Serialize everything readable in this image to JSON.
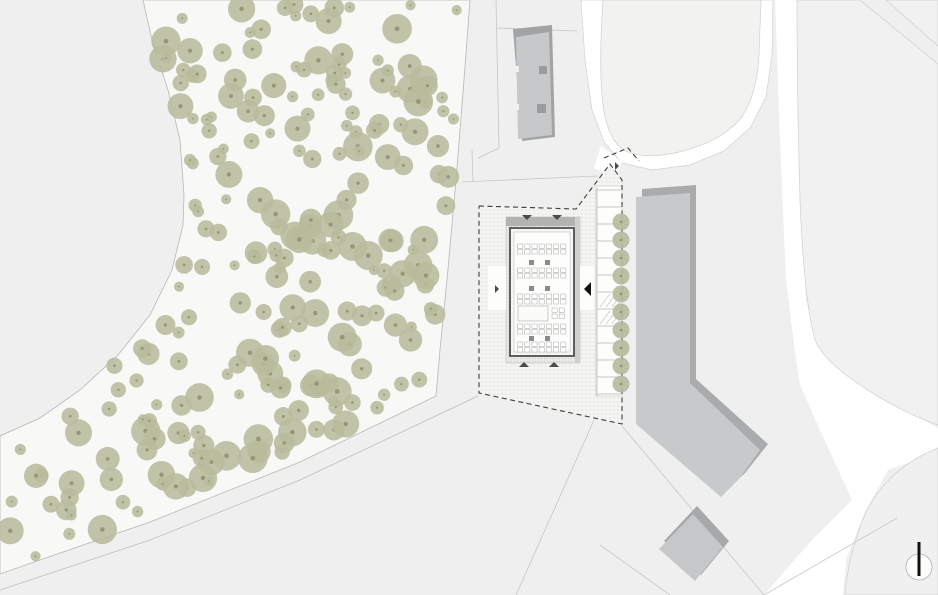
{
  "canvas": {
    "w": 938,
    "h": 595,
    "background": "#efefef"
  },
  "palette": {
    "base": "#efefef",
    "woodland": "#f8f8f6",
    "road": "#ffffff",
    "parcel": "#f1f1f2",
    "parcel_line": "#c6c6c4",
    "tree_fill": "#b7bb9c",
    "tree_dot": "#8f946f",
    "building_fill": "#c8c9ca",
    "building_shadow": "#a8a9ab",
    "deck_fill": "#e9e9e7",
    "roof_shade": "#b3b3b1",
    "wall_stroke": "#4f4f53",
    "floor_fill": "#fdfdfc",
    "furniture_stroke": "#a8a8a6",
    "column_fill": "#8b8b8d",
    "boundary_dash": "#3d3d3d",
    "stipple_dot": "#c8c8c4",
    "north_needle": "#111111"
  },
  "shapes": [
    {
      "name": "base-ground",
      "type": "rect",
      "x": 0,
      "y": 0,
      "w": 938,
      "h": 595,
      "fill": "#efefef"
    },
    {
      "name": "woodland-area",
      "type": "polygon",
      "points": "143,0 470,0 464,80 456,180 447,280 440,350 436,396 300,462 150,522 40,560 0,574 0,436 40,418 80,390 118,355 150,315 172,270 183,225 184,195 180,140 168,90 152,40",
      "fill": "#f8f8f6",
      "stroke": "#b7b7b5",
      "sw": 0.8
    },
    {
      "name": "footpath-lower-line",
      "type": "polyline",
      "points": "0,590 150,540 300,480 440,414 478,396",
      "stroke": "#bdbdbb",
      "sw": 0.8
    },
    {
      "name": "road-top-loop",
      "type": "polygon",
      "points": "581,0 585,60 592,110 604,142 622,163 652,170 690,165 724,151 750,128 766,97 772,55 773,0",
      "fill": "#ffffff",
      "stroke": "#d2d2d0",
      "sw": 0.7
    },
    {
      "name": "parcel-island-north",
      "type": "path",
      "d": "M603,0 Q599,60 602,95 Q605,135 622,149 Q640,160 675,153 Q720,143 741,118 Q757,95 759,55 L761,0 Z",
      "fill": "#f2f3f1",
      "stroke": "#cfcfcd",
      "sw": 0.7
    },
    {
      "name": "road-entrance-spur",
      "type": "polygon",
      "points": "601,146 622,162 616,178 594,168",
      "fill": "#ffffff"
    },
    {
      "name": "road-east-vertical",
      "type": "polygon",
      "points": "775,0 799,0 800,150 806,300 817,342 795,352 786,280 780,140",
      "fill": "#ffffff"
    },
    {
      "name": "road-southeast-wedge",
      "type": "polygon",
      "points": "795,352 817,342 852,376 892,402 938,428 938,452 888,470 864,514 846,560 843,595 764,595 812,540 852,500 820,430 800,385",
      "fill": "#ffffff"
    },
    {
      "name": "parcel-east",
      "type": "path",
      "d": "M797,0 L860,0 L938,64 L938,425 L920,418 Q885,403 850,378 Q822,357 815,340 Q804,300 800,200 Q797,90 797,0 Z",
      "fill": "#f1f1f2",
      "stroke": "#cfcfcd",
      "sw": 0.7
    },
    {
      "name": "parcel-corner-northeast",
      "type": "polygon",
      "points": "886,0 938,0 938,46",
      "fill": "#f1f1f2",
      "stroke": "#cfcfcd",
      "sw": 0.7
    },
    {
      "name": "parcel-southeast",
      "type": "path",
      "d": "M938,448 Q888,468 866,512 Q848,555 845,595 L938,595 Z",
      "fill": "#f0f0f1",
      "stroke": "#cfcfcd",
      "sw": 0.7
    },
    {
      "name": "parcel-lines",
      "type": "lines",
      "stroke": "#c6c6c4",
      "sw": 0.8,
      "items": [
        "496,0 499,148",
        "499,148 478,158",
        "462,182 597,176",
        "472,150 473,182",
        "497,28 577,31",
        "594,420 516,595",
        "622,426 764,595",
        "764,595 897,518",
        "670,595 600,545"
      ]
    },
    {
      "name": "site-ground",
      "type": "stipple-polygon",
      "points": "479,206 576,209 610,164 622,180 622,424 479,393",
      "fill": "#f4f4f2",
      "pattern": "dots"
    },
    {
      "name": "parking-area",
      "type": "rect",
      "x": 596,
      "y": 186,
      "w": 26,
      "h": 210,
      "fill": "#fdfdfc",
      "stroke": "#c9c9c7",
      "sw": 0.7
    },
    {
      "name": "parking-stalls",
      "type": "parking",
      "x1": 597,
      "x2": 621,
      "yStart": 190,
      "yEnd": 394,
      "count": 13,
      "hatch": [
        6,
        7
      ],
      "stroke": "#b4b4b2",
      "sw": 0.7
    },
    {
      "name": "site-boundary",
      "type": "dashed",
      "points": "479,206 576,209 610,164 622,180 622,424 479,393 479,206",
      "stroke": "#3d3d3d",
      "sw": 1.1,
      "dash": "5,3.5"
    },
    {
      "name": "site-boundary-entrance",
      "type": "dashed",
      "points": "604,158 628,148 639,161",
      "stroke": "#3d3d3d",
      "sw": 1.1,
      "dash": "5,3.5"
    },
    {
      "name": "main-building-deck",
      "type": "rect",
      "x": 506,
      "y": 217,
      "w": 74,
      "h": 146,
      "fill": "#e9e9e7",
      "stroke": "#b9b9b7",
      "sw": 0.6
    },
    {
      "name": "main-building-deck-stipple",
      "type": "stipple-rect",
      "x": 506,
      "y": 217,
      "w": 74,
      "h": 146,
      "pattern": "dots2"
    },
    {
      "name": "main-building-roof-shade-top",
      "type": "rect",
      "x": 506,
      "y": 217,
      "w": 74,
      "h": 9,
      "fill": "#b3b3b1"
    },
    {
      "name": "main-building-roof-shade-right",
      "type": "rect",
      "x": 575,
      "y": 217,
      "w": 5,
      "h": 146,
      "fill": "#cfcfcd"
    },
    {
      "name": "entry-court-west",
      "type": "rect",
      "x": 488,
      "y": 266,
      "w": 18,
      "h": 44,
      "fill": "#fdfdfc"
    },
    {
      "name": "entry-court-east",
      "type": "rect",
      "x": 580,
      "y": 266,
      "w": 14,
      "h": 44,
      "fill": "#fdfdfc"
    },
    {
      "name": "main-building-wall",
      "type": "rect",
      "x": 510,
      "y": 228,
      "w": 64,
      "h": 128,
      "fill": "#f5f5f3",
      "stroke": "#4f4f53",
      "sw": 1.8
    },
    {
      "name": "main-building-floor",
      "type": "rect",
      "x": 514,
      "y": 232,
      "w": 56,
      "h": 120,
      "fill": "#fdfdfc",
      "stroke": "#b5b5b3",
      "sw": 0.5
    },
    {
      "name": "main-building-furniture",
      "type": "furniture",
      "fx": 514,
      "fy": 232,
      "fw": 56,
      "rows": [
        {
          "t": "grid",
          "y": 12
        },
        {
          "t": "cols",
          "y": 28
        },
        {
          "t": "grid",
          "y": 36
        },
        {
          "t": "cols",
          "y": 54
        },
        {
          "t": "grid",
          "y": 62
        },
        {
          "t": "void",
          "y": 74
        },
        {
          "t": "grid",
          "y": 92
        },
        {
          "t": "cols",
          "y": 104
        },
        {
          "t": "grid",
          "y": 110
        }
      ],
      "cell_stroke": "#a8a8a6",
      "col_fill": "#8b8b8d"
    },
    {
      "name": "building-north-shadow",
      "type": "polygon",
      "points": "513,29 552,25 555,137 522,141",
      "fill": "#a2a3a5"
    },
    {
      "name": "building-north",
      "type": "polygon",
      "points": "516,37 549,32 552,135 518,139",
      "fill": "#c7c8c9"
    },
    {
      "name": "building-north-notch-1",
      "type": "rect",
      "x": 539,
      "y": 66,
      "w": 8,
      "h": 8,
      "fill": "#9b9c9e"
    },
    {
      "name": "building-north-notch-2",
      "type": "rect",
      "x": 537,
      "y": 104,
      "w": 9,
      "h": 9,
      "fill": "#9b9c9e"
    },
    {
      "name": "building-north-cut-1",
      "type": "rect",
      "x": 514,
      "y": 66,
      "w": 5,
      "h": 6,
      "fill": "#f1f1ef"
    },
    {
      "name": "building-north-cut-2",
      "type": "rect",
      "x": 514,
      "y": 104,
      "w": 5,
      "h": 6,
      "fill": "#f1f1ef"
    },
    {
      "name": "building-east-shadow",
      "type": "polygon",
      "points": "642,189 696,185 696,379 768,444 745,473 727,490 642,416",
      "fill": "#aaabad"
    },
    {
      "name": "building-east",
      "type": "polygon",
      "points": "636,197 690,193 690,383 760,450 739,479 721,497 636,424",
      "fill": "#c8c9ca"
    },
    {
      "name": "building-kiosk-shadow",
      "type": "polygon",
      "points": "697,506 729,541 701,575 664,541",
      "fill": "#a7a8aa"
    },
    {
      "name": "building-kiosk",
      "type": "polygon",
      "points": "693,514 723,547 695,581 659,549",
      "fill": "#c6c7c8"
    },
    {
      "name": "woodland-trees",
      "type": "tree-field",
      "count": 240,
      "seed": 11,
      "rmin": 5,
      "rmax": 15,
      "polygon": "150,4 464,4 458,90 450,190 442,285 435,350 431,392 298,457 150,517 42,555 6,568 6,440 42,415 82,387 120,352 152,312 174,268 185,224 186,195 182,140 170,88 155,42",
      "fill": "#b7bb9c",
      "dot": "#8f946f",
      "opacity": 0.88
    },
    {
      "name": "parking-tree-row",
      "type": "tree-row",
      "x": 621,
      "ys": [
        222,
        240,
        258,
        276,
        294,
        312,
        330,
        348,
        366,
        384
      ],
      "r": 8.5,
      "fill": "#b7bb9c",
      "dot": "#8f946f",
      "opacity": 0.92
    },
    {
      "name": "entrance-arrows",
      "type": "arrows",
      "color": "#4a4a4a",
      "items": [
        {
          "x": 527,
          "y": 220,
          "dir": "down",
          "size": 5
        },
        {
          "x": 557,
          "y": 220,
          "dir": "down",
          "size": 5
        },
        {
          "x": 524,
          "y": 362,
          "dir": "up",
          "size": 5
        },
        {
          "x": 554,
          "y": 362,
          "dir": "up",
          "size": 5
        },
        {
          "x": 499,
          "y": 289,
          "dir": "right",
          "size": 4
        },
        {
          "x": 619,
          "y": 166,
          "dir": "right",
          "size": 4
        },
        {
          "x": 584,
          "y": 289,
          "dir": "left",
          "size": 7,
          "color": "#111111"
        }
      ]
    },
    {
      "name": "north-arrow",
      "type": "north",
      "cx": 919,
      "cy": 567,
      "r": 13,
      "ring_stroke": "#b0b0ae",
      "ring_fill": "#fdfdfc",
      "needle_x": 917.5,
      "needle_y": 542,
      "needle_w": 3,
      "needle_h": 34,
      "needle_fill": "#111111"
    }
  ]
}
